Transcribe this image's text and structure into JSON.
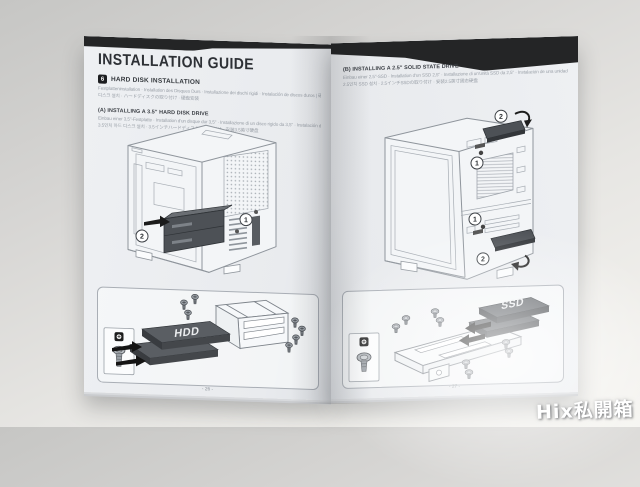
{
  "watermark": "Hix私開箱",
  "colors": {
    "band": "#242526",
    "page": "#edeff2",
    "line_art": "#8f959c",
    "drive_dark": "#4d5156"
  },
  "booklet": {
    "title": "INSTALLATION GUIDE",
    "left_page": {
      "section_number": "6",
      "section_title": "HARD DISK INSTALLATION",
      "section_sub1": "Festplatteninstallation · Installation des Disques Durs · Installazione dei dischi rigidi · Instalación de discos duros | 硬碟安裝 / 하드",
      "section_sub2": "디스크 설치 · ハードディスクの取り付け · 硬盘安装",
      "sub_a_title": "(A) INSTALLING A 3.5\" HARD DISK DRIVE",
      "sub_a_line1": "Einbau einer 3,5\"-Festplatte · Installation d'un disque dur 3,5\" · Installazione di un disco rigido da 3,5\" · Instalación de un disco duro de 3,5\" | 安裝3.5吋硬碟 ·",
      "sub_a_line2": "3.5인치 하드 디스크 설치 · 3.5インチハードディスクの取り付け · 安装3.5英寸硬盘",
      "step1": "1",
      "step2": "2",
      "detail_drive_label": "HDD",
      "page_number": "- 26 -"
    },
    "right_page": {
      "sub_b_title": "(B) INSTALLING A 2.5\" SOLID STATE DRIVE",
      "sub_b_line1": "Einbau einer 2,5\"-SSD · Installation d'un SSD 2,5\" · Installazione di un'unità SSD da 2,5\" · Instalación de una unidad SSD de 2,5\" | 安裝2.5吋固態硬碟 ·",
      "sub_b_line2": "2.5인치 SSD 설치 · 2.5インチSSDの取り付け · 安装2.5英寸固态硬盘",
      "step1": "1",
      "step2": "2",
      "detail_drive_label": "SSD",
      "page_number": "- 27 -"
    }
  }
}
